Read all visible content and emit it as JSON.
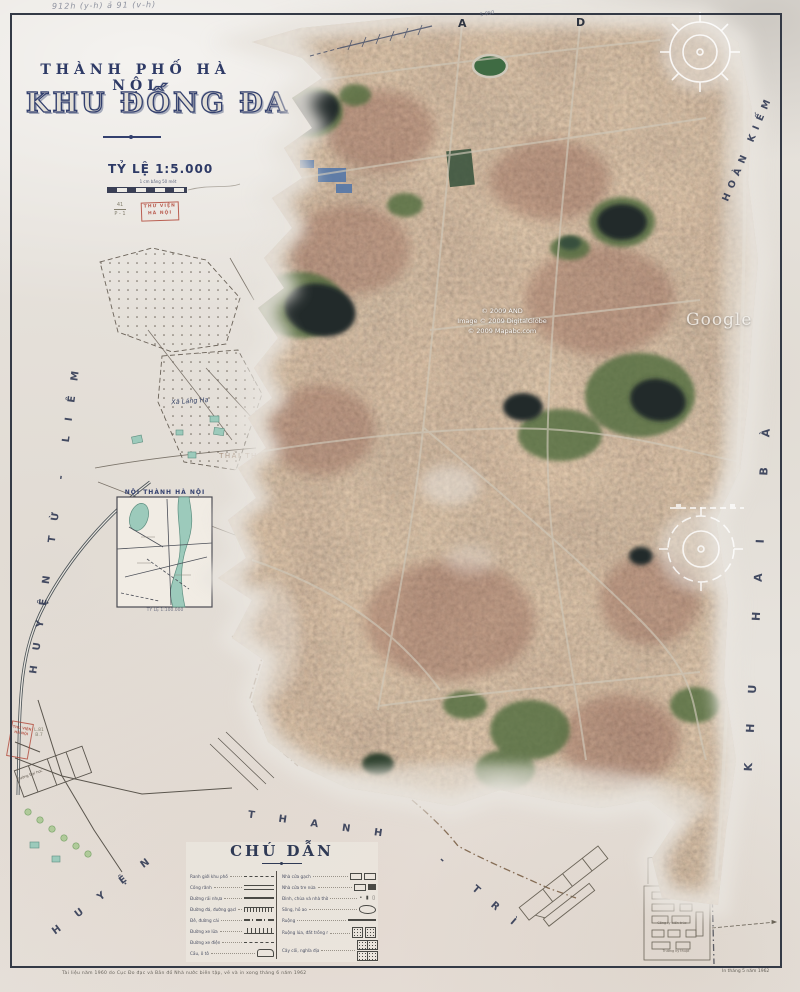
{
  "header": {
    "handwritten_note": "912h (y-h) ả 91 (v-h)",
    "city_title": "THÀNH PHỐ HÀ NỘI",
    "district_title": "KHU ĐỐNG ĐA",
    "scale_title": "TỶ LỆ 1:5.000",
    "scale_caption": "1 cm bằng 50 mét",
    "pencil_ref_top": "41",
    "pencil_ref_bottom": "P - 1",
    "stamp_line1": "THƯ VIỆN",
    "stamp_line2": "HÀ NỘI"
  },
  "grid": {
    "letter_a": "A",
    "letter_d": "D",
    "road_note": "5-850"
  },
  "neighbors": {
    "left": "HUYỆN TỪ - LIÊM",
    "bottom_1": "HUYỆN",
    "bottom_2": "THANH",
    "bottom_3": "- TRÌ",
    "top_right": "HOÀN KIẾM",
    "right": "KHU HAI BÀ"
  },
  "places": {
    "xa_lang_ha": "Xã Láng Hạ",
    "thai_thinh": "THÁI THỊNH",
    "site_label_1": "Công ty kiến trúc",
    "site_label_2": "Trường kỹ thuật",
    "school_label": "Trường Đại học"
  },
  "inset": {
    "title": "NỘI THÀNH HÀ NỘI",
    "caption": "TỶ LỆ 1:100.000"
  },
  "margin": {
    "stamp_line1": "THƯ VIỆN",
    "stamp_line2": "HÀ NỘI",
    "pencil_note": "L.81 B.7"
  },
  "legend": {
    "title": "CHÚ DẪN",
    "left_labels": [
      "Ranh giới khu phố",
      "Cống rãnh",
      "Đường rải nhựa",
      "Đường đá, đường gạch",
      "Đê, đường cái",
      "Đường xe lửa",
      "Đường xe điện",
      "Cầu, ô tô"
    ],
    "right_labels": [
      "Nhà cửa gạch",
      "Nhà cửa tre nứa",
      "Đình, chùa và nhà thờ",
      "Sông, hồ ao",
      "Ruộng",
      "Ruộng lúa, đất trồng màu",
      "Cây cối, nghĩa địa"
    ]
  },
  "imprints": {
    "bottom_left": "Tài liệu năm 1960 do Cục Đo đạc và Bản đồ Nhà nước biên tập, vẽ và in xong tháng 6 năm 1962",
    "bottom_right": "In tháng 5 năm 1962"
  },
  "satellite": {
    "watermark": "Google",
    "copyright_1": "© 2009 AND",
    "copyright_2": "Image © 2009 DigitalGlobe",
    "copyright_3": "© 2009 Mapabc.com"
  },
  "colors": {
    "paper": "#e7e3dd",
    "ink_navy": "#2f3a5e",
    "stamp_red": "#b2483a",
    "water_teal": "#9ccabb",
    "satellite_base": "#8f7465"
  }
}
